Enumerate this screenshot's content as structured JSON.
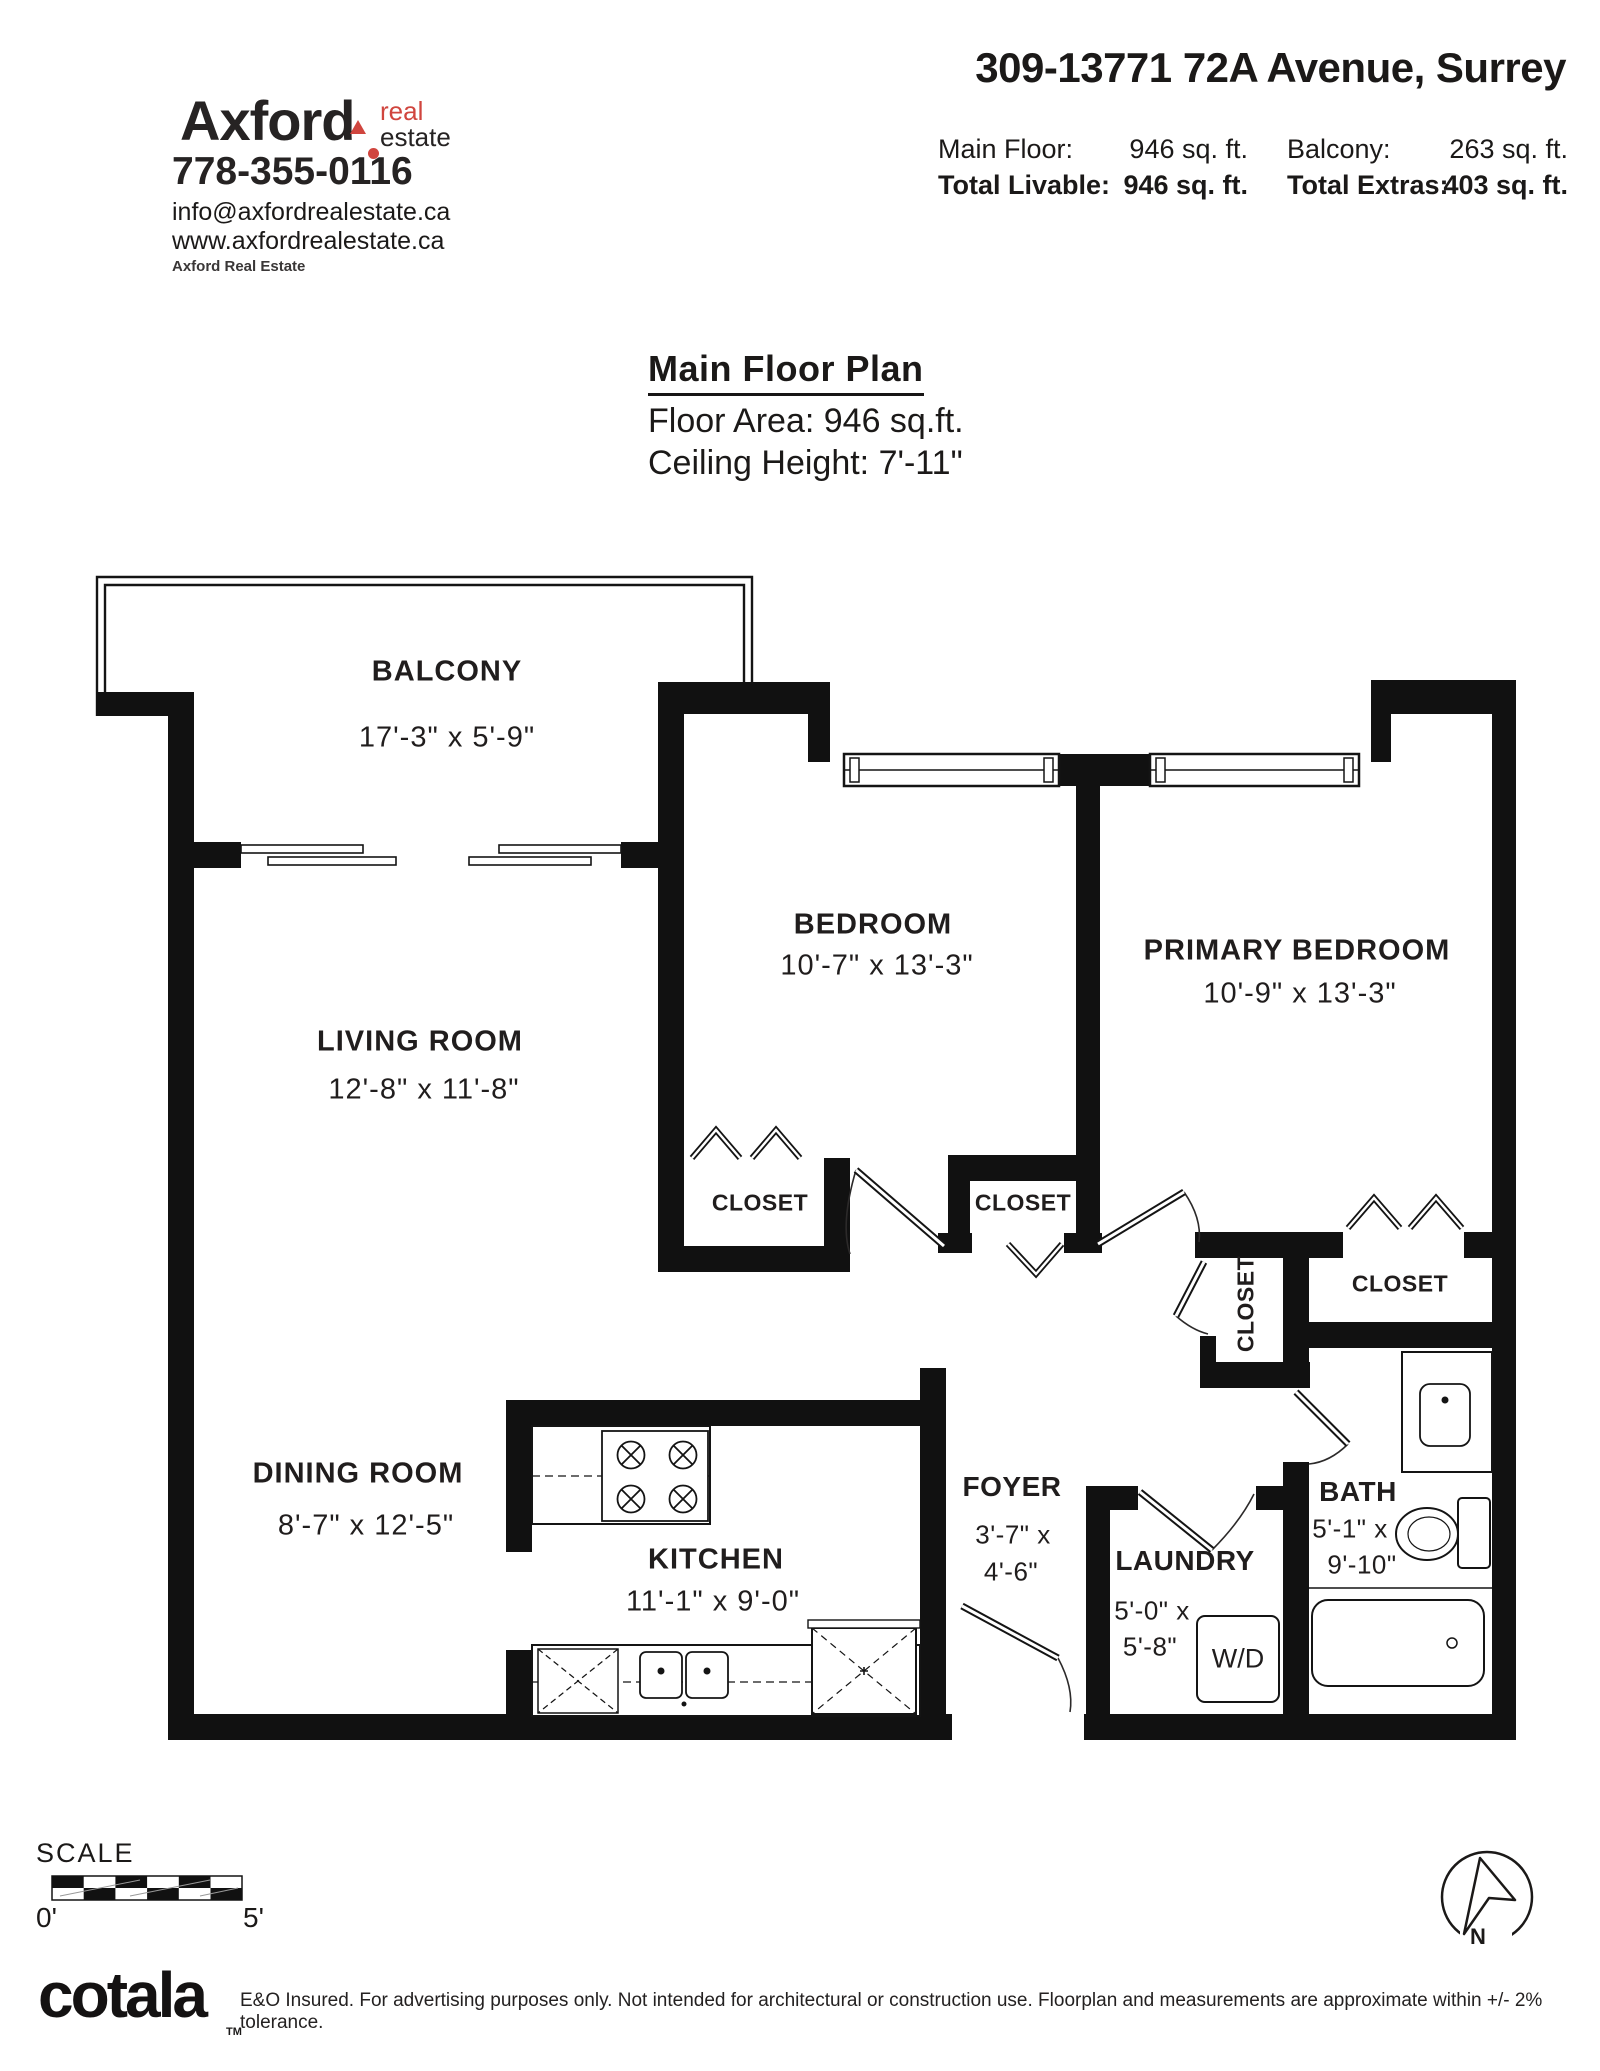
{
  "header": {
    "brand": {
      "name": "Axford",
      "tag_line1": "real",
      "tag_line2": "estate",
      "phone": "778-355-0116",
      "email": "info@axfordrealestate.ca",
      "website": "www.axfordrealestate.ca",
      "company": "Axford Real Estate"
    },
    "address": "309-13771 72A Avenue, Surrey",
    "stats": {
      "row1": [
        {
          "label": "Main Floor:",
          "value": "946 sq. ft."
        },
        {
          "label": "Balcony:",
          "value": "263 sq. ft."
        }
      ],
      "row2": [
        {
          "label": "Total Livable:",
          "value": "946 sq. ft."
        },
        {
          "label": "Total Extras:",
          "value": "403 sq. ft."
        }
      ]
    }
  },
  "plan": {
    "title": "Main Floor Plan",
    "floor_area": "Floor Area: 946 sq.ft.",
    "ceiling_height": "Ceiling Height: 7'-11\"",
    "rooms": {
      "balcony": {
        "name": "BALCONY",
        "dims": "17'-3\" x  5'-9\""
      },
      "living": {
        "name": "LIVING ROOM",
        "dims": "12'-8\" x 11'-8\""
      },
      "bedroom": {
        "name": "BEDROOM",
        "dims": "10'-7\" x 13'-3\""
      },
      "primary": {
        "name": "PRIMARY BEDROOM",
        "dims": "10'-9\" x 13'-3\""
      },
      "dining": {
        "name": "DINING ROOM",
        "dims": "8'-7\" x 12'-5\""
      },
      "kitchen": {
        "name": "KITCHEN",
        "dims": "11'-1\" x  9'-0\""
      },
      "foyer": {
        "name": "FOYER",
        "dims_line1": "3'-7\" x",
        "dims_line2": "4'-6\""
      },
      "laundry": {
        "name": "LAUNDRY",
        "dims_line1": "5'-0\" x",
        "dims_line2": "5'-8\""
      },
      "bath": {
        "name": "BATH",
        "dims_line1": "5'-1\" x",
        "dims_line2": "9'-10\""
      }
    },
    "closet_labels": [
      "CLOSET",
      "CLOSET",
      "CLOSET",
      "CLOSET"
    ],
    "fixtures": {
      "washer_dryer": "W/D"
    },
    "scale": {
      "label": "SCALE",
      "start": "0'",
      "end": "5'"
    },
    "compass": {
      "north": "N"
    }
  },
  "footer": {
    "brand": "cotala",
    "trademark": "TM",
    "disclaimer": "E&O Insured. For advertising purposes only. Not intended for architectural or construction use. Floorplan and measurements are approximate within +/- 2% tolerance.",
    "ink_color": "#1b1918",
    "accent_color": "#d0453e"
  }
}
